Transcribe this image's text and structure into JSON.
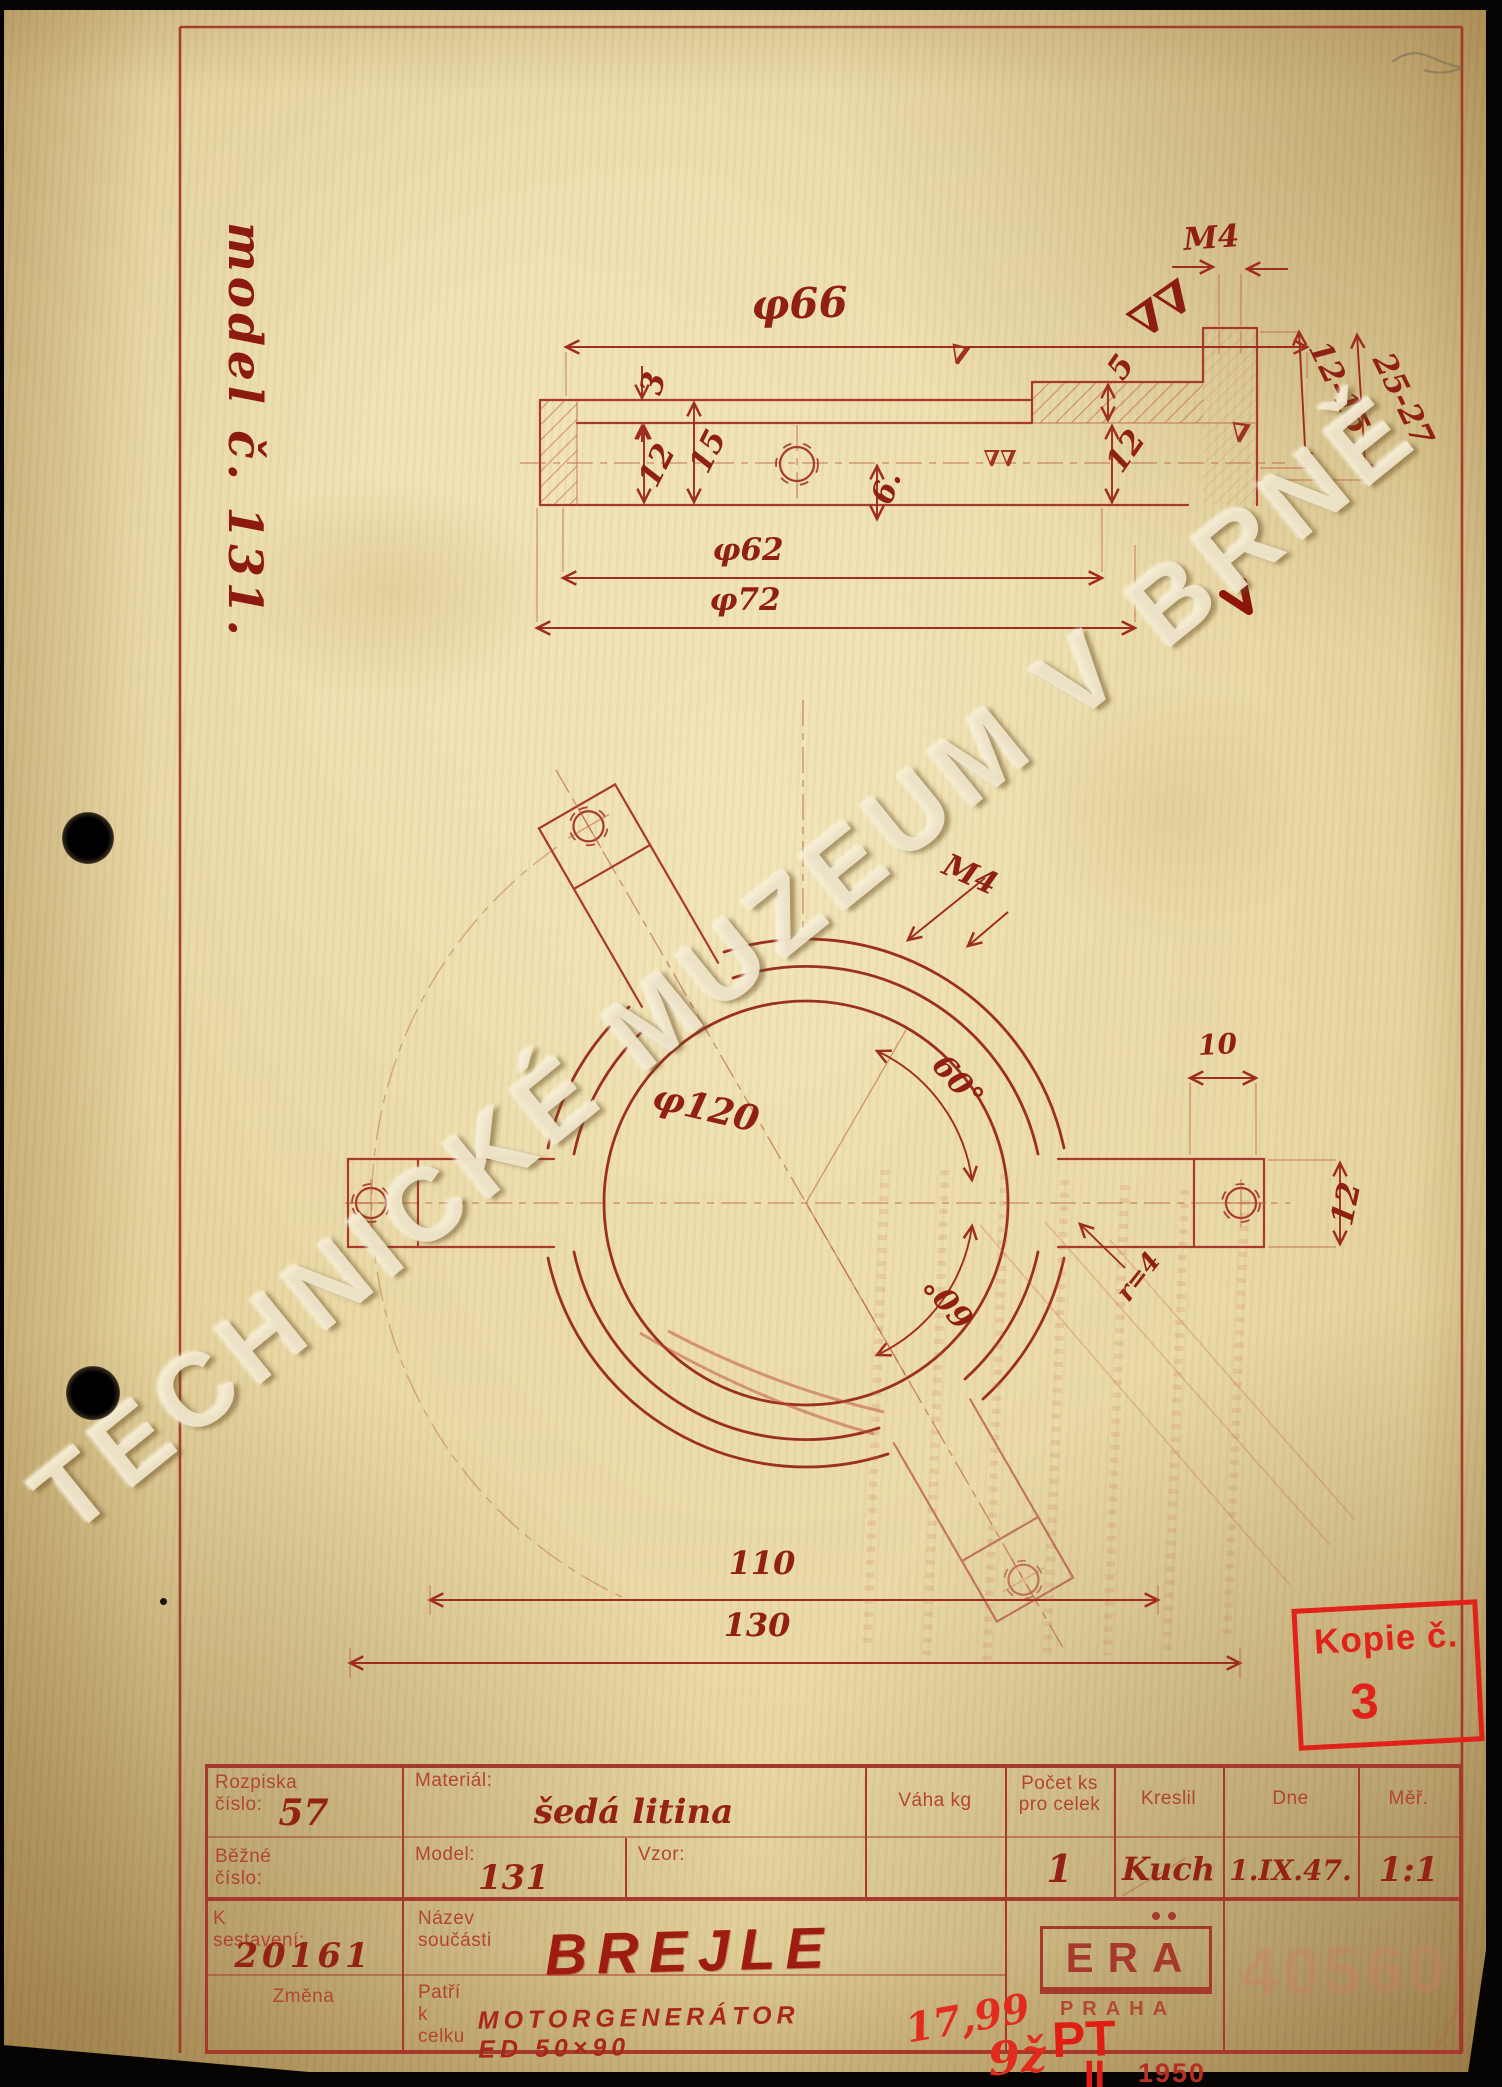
{
  "page": {
    "watermark": "TECHNICKÉ MUZEUM V BRNĚ",
    "margin_note": "model č. 131."
  },
  "top_view": {
    "phi66": "φ66",
    "phi62": "φ62",
    "phi72": "φ72",
    "t3": "3",
    "t15": "15",
    "t12": "12",
    "d6": "6.",
    "t5": "5",
    "t12r": "12",
    "m4": "M4",
    "range_a": "12-15",
    "range_b": "25-27",
    "finish_single": "∇",
    "finish_double": "∇∇"
  },
  "plan_view": {
    "phi120": "φ120",
    "m4": "M4",
    "angle_a": "60°",
    "angle_b": "60°",
    "d10": "10",
    "d12": "12",
    "r4": "r=4",
    "d110": "110",
    "d130": "130"
  },
  "stamps": {
    "kopie_label": "Kopie č.",
    "kopie_number": "3",
    "era_name": "ERA",
    "era_city": "PRAHA",
    "ghost_number": "40560",
    "note_price": "17,99",
    "note_code": "9ž",
    "note_stamp": "PT",
    "note_roman": "II",
    "note_year": "1950"
  },
  "title_block": {
    "rozpiska_label": "Rozpiska číslo:",
    "rozpiska_value": "57",
    "bezne_label": "Běžné číslo:",
    "material_label": "Materiál:",
    "material_value": "šedá litina",
    "model_label": "Model:",
    "model_value": "131",
    "vzor_label": "Vzor:",
    "vaha_label": "Váha kg",
    "pocet_label_line1": "Počet ks",
    "pocet_label_line2": "pro celek",
    "pocet_value": "1",
    "kreslil_label": "Kreslil",
    "kreslil_value": "Kuch",
    "dne_label": "Dne",
    "dne_value": "1.IX.47.",
    "mer_label": "Měř.",
    "mer_value": "1:1",
    "k_sestaveni_label": "K sestavení:",
    "k_sestaveni_value": "20161",
    "zmena_label": "Změna",
    "nazev_label": "Název součásti",
    "nazev_value": "BREJLE",
    "patri_label": "Patří k celku",
    "patri_value": "MOTORGENERÁTOR  ED 50×90"
  }
}
